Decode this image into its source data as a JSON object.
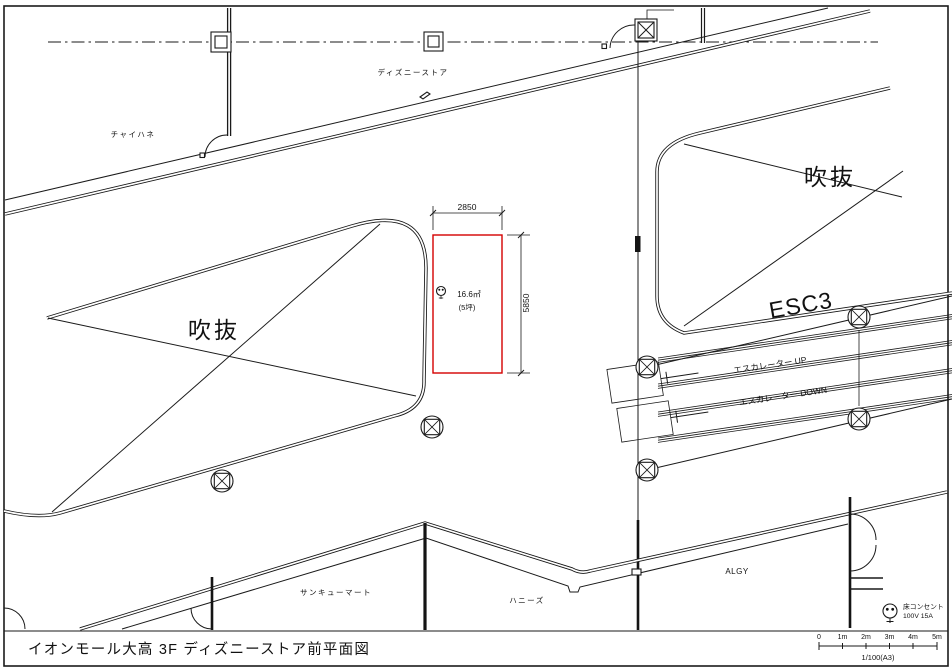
{
  "drawing": {
    "title": "イオンモール大高 3F ディズニーストア前平面図",
    "tenants": {
      "chaihane": "チャイハネ",
      "disney": "ディズニーストア",
      "thankyou_mart": "サンキューマート",
      "honeys": "ハニーズ",
      "algy": "ALGY"
    },
    "voids": {
      "left": "吹抜",
      "right": "吹抜"
    },
    "escalators": {
      "esc3": "ESC3",
      "up": "エスカレーター UP",
      "down": "エスカレーター DOWN"
    },
    "vacant_unit": {
      "width_mm": "2850",
      "height_mm": "5850",
      "area": "16.6㎡",
      "tsubo": "(5坪)"
    },
    "legend": {
      "outlet": "床コンセント",
      "spec": "100V 15A"
    },
    "scalebar": {
      "ticks": [
        "0",
        "1m",
        "2m",
        "3m",
        "4m",
        "5m"
      ],
      "ratio": "1/100(A3)"
    },
    "colors": {
      "line": "#1a1a1a",
      "vacant_unit_outline": "#d40000",
      "paper": "#ffffff"
    }
  }
}
